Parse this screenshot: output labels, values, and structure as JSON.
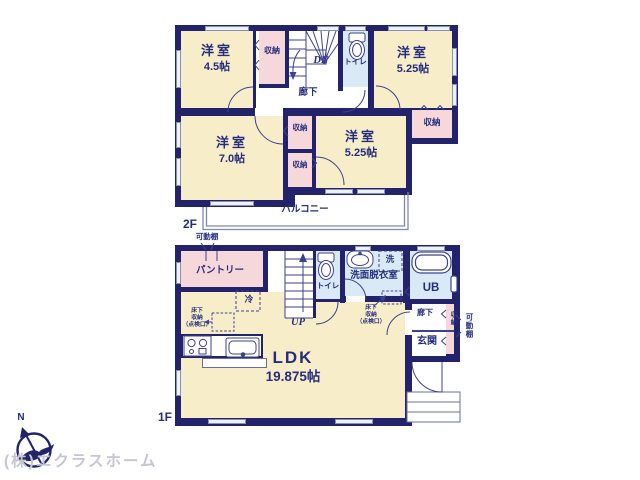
{
  "floor2": {
    "label": "2F",
    "rooms": [
      {
        "name": "洋室",
        "size": "4.5帖"
      },
      {
        "name": "洋室",
        "size": "5.25帖"
      },
      {
        "name": "洋室",
        "size": "7.0帖"
      },
      {
        "name": "洋室",
        "size": "5.25帖"
      }
    ],
    "closet_label": "収納",
    "stairs_label": "DN",
    "toilet_label": "トイレ",
    "hallway_label": "廊下",
    "balcony_label": "バルコニー"
  },
  "floor1": {
    "label": "1F",
    "ldk": {
      "name": "LDK",
      "size": "19.875帖"
    },
    "pantry_label": "パントリー",
    "fridge_label": "冷",
    "stairs_label": "UP",
    "toilet_label": "トイレ",
    "washer_label": "洗",
    "washroom_label": "洗面脱衣室",
    "bath_label": "UB",
    "hallway_label": "廊下",
    "closet_label": "収納",
    "entrance_label": "玄関",
    "shelf_label": "可動棚",
    "underfloor": {
      "line1": "床下",
      "line2": "収納",
      "line3": "（点検口）"
    }
  },
  "compass": {
    "north_label": "N"
  },
  "watermark": "(株)エクラスホーム",
  "colors": {
    "wall_navy": "#23236b",
    "line_navy": "#3d4191",
    "text_navy": "#252e7e",
    "room_cream": "#f8edc9",
    "closet_pink": "#f6d7da",
    "wet_area_blue": "#d9eaf6",
    "watermark_gray": "#c5c6d2"
  }
}
